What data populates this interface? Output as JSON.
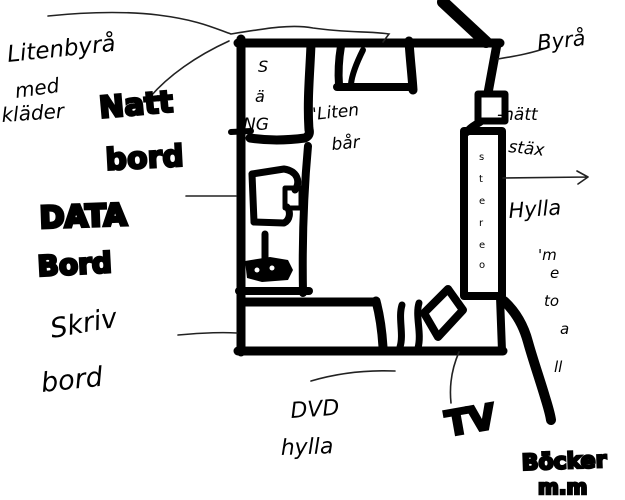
{
  "canvas": {
    "background": "#ffffff",
    "ink_color": "#000000",
    "thin_pen_color": "#222222"
  },
  "labels": {
    "dresser_note": {
      "line1": "Litenbyrå",
      "line2": "med",
      "line3": "kläder"
    },
    "nightstand": {
      "line1": "Natt",
      "line2": "bord"
    },
    "computer_desk": {
      "line1": "DATA",
      "line2": "Bord"
    },
    "writing_desk": {
      "line1": "Skriv",
      "line2": "bord"
    },
    "bed_vertical": [
      "S",
      "ä",
      "NG"
    ],
    "small_shelf": {
      "line1": "'Liten",
      "line2": "bår"
    },
    "dresser_top": "Byrå",
    "wall_cabinet": {
      "line1": "-nätt",
      "line2": "stäx"
    },
    "stereo_vertical": [
      "s",
      "t",
      "e",
      "r",
      "e",
      "o"
    ],
    "shelf": "Hylla",
    "shelf_note_vertical": [
      "'m",
      "e",
      "to",
      "a",
      "ll"
    ],
    "dvd_shelf": {
      "line1": "DVD",
      "line2": "hylla"
    },
    "tv": "TV",
    "books": {
      "line1": "Böcker",
      "line2": "m.m"
    }
  }
}
